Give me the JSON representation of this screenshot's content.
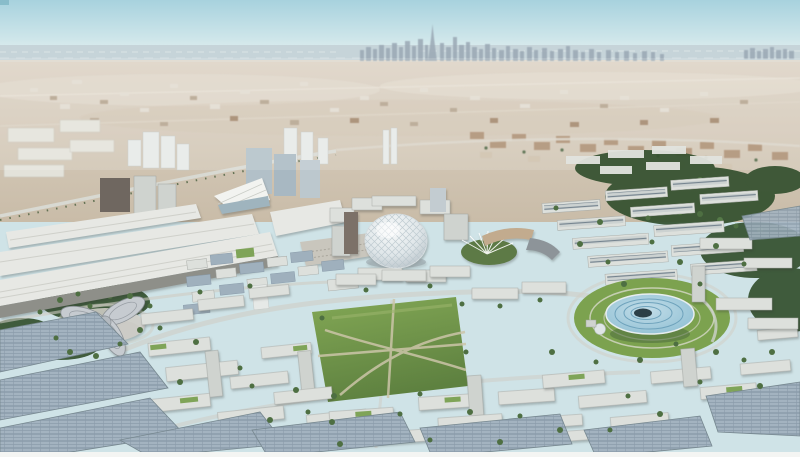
{
  "scene": {
    "type": "aerial-architectural-rendering",
    "description": "Bird's-eye rendering of a circular expo master-plan city in the desert: a central white lattice dome, a disc-shaped pavilion with concentric rings on a lawn, a three-lobed pavilion, long white exhibition halls, a central park, white mid-rise courtyard blocks with green and solar roofs, dense tree canopy to the east, and a distant high-rise skyline with a supertall spire on a hazy sea horizon.",
    "time_of_day": "day",
    "landmarks": [
      {
        "id": "distant-skyline",
        "label": "Distant city skyline with supertall tower"
      },
      {
        "id": "sea-horizon",
        "label": "Hazy sea along the horizon"
      },
      {
        "id": "desert-midground",
        "label": "Desert plain with scattered low-rise districts"
      },
      {
        "id": "exhibition-halls",
        "label": "Long white exhibition halls with entrance canopy"
      },
      {
        "id": "al-wasl-dome",
        "label": "Central white lattice dome"
      },
      {
        "id": "mobility-pavilion-trefoil",
        "label": "Three-lobed pinwheel pavilion"
      },
      {
        "id": "sustainability-pavilion-disc",
        "label": "Disc-shaped pavilion with concentric rings"
      },
      {
        "id": "central-park",
        "label": "Central park lawn with crossing paths"
      },
      {
        "id": "residential-blocks",
        "label": "White mid-rise blocks, some with green roofs"
      },
      {
        "id": "solar-canopies",
        "label": "Solar-panel roof canopies"
      },
      {
        "id": "tree-canopy",
        "label": "Dense green tree canopy"
      }
    ]
  },
  "colors": {
    "sky_top": "#a7d2de",
    "sky_mid": "#cfe6ea",
    "sky_horizon": "#eef3f1",
    "sea": "#c6d4d9",
    "shore": "#e0d8ca",
    "desert_far": "#dcd2c4",
    "desert_near": "#c9bca8",
    "skyline": "#9aa8b4",
    "hall_roof": "#e7e8e4",
    "hall_face": "#8e8f89",
    "dome_light": "#f7f9f9",
    "dome_shade": "#aeb9c0",
    "park_light": "#83a855",
    "park_dark": "#5e8140",
    "lawn": "#7ca24f",
    "disc_light": "#c2dde8",
    "disc_deep": "#8bbdd2",
    "disc_ring": "#6fa3bc",
    "disc_core": "#2c3f47",
    "building_white": "#dde0dc",
    "green_roof": "#7fa458",
    "solar_roof": "#9fb0bd",
    "tree_dark": "#33502e",
    "tree_light": "#4e6f42",
    "road": "#cfccc3",
    "bottom_strip": "#f4f5f3"
  }
}
